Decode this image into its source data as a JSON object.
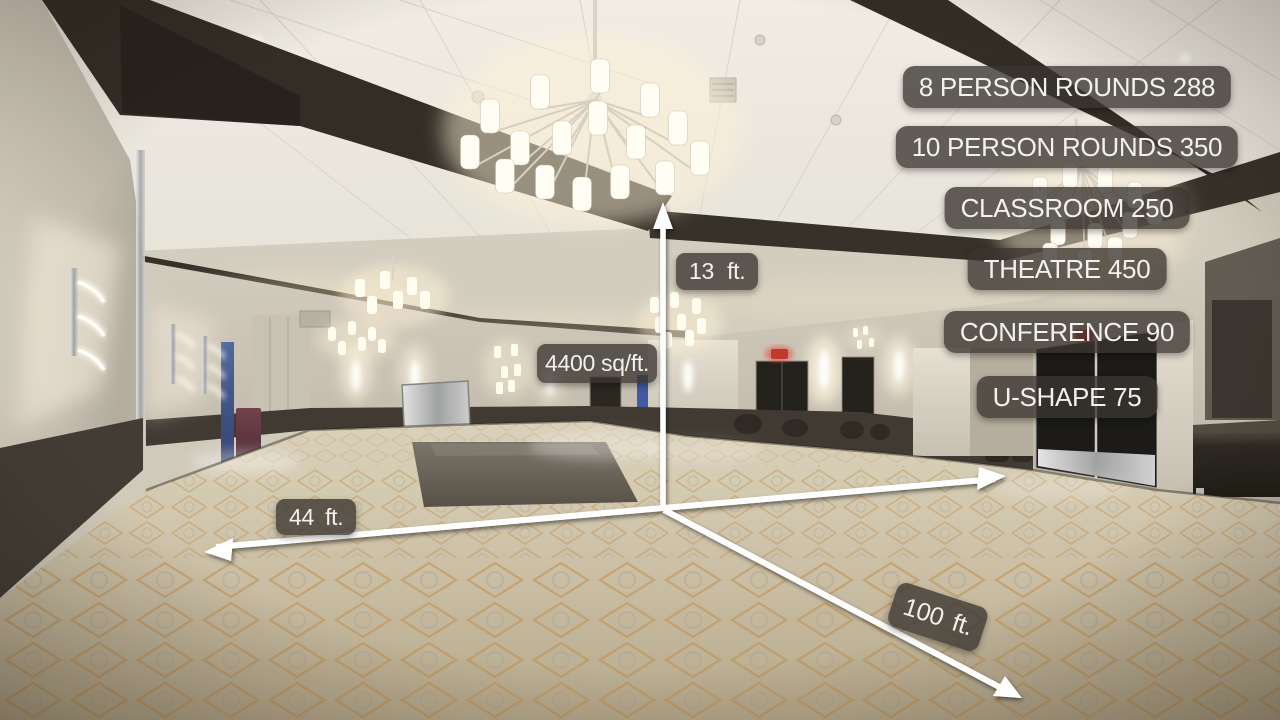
{
  "overlay": {
    "capacity_list": {
      "items": [
        {
          "label": "8 PERSON ROUNDS 288"
        },
        {
          "label": "10 PERSON ROUNDS 350"
        },
        {
          "label": "CLASSROOM 250"
        },
        {
          "label": "THEATRE 450"
        },
        {
          "label": "CONFERENCE 90"
        },
        {
          "label": "U-SHAPE 75"
        }
      ]
    },
    "dimensions": {
      "height": {
        "label": "13 ft."
      },
      "area": {
        "label": "4400 sq/ft."
      },
      "width": {
        "label": "44 ft."
      },
      "length": {
        "label": "100 ft."
      }
    },
    "style": {
      "badge_background": "rgba(58,53,47,0.78)",
      "badge_text_color": "#f2f1ef",
      "arrow_color": "#ffffff"
    }
  },
  "scene": {
    "setting": "empty ballroom",
    "elements": [
      "chandelier",
      "ceiling-beams",
      "wall-sconces",
      "dark-doors",
      "exit-sign",
      "patterned-carpet",
      "dance-floor",
      "blue-drape",
      "podium",
      "mirror-panel",
      "credenza"
    ]
  }
}
